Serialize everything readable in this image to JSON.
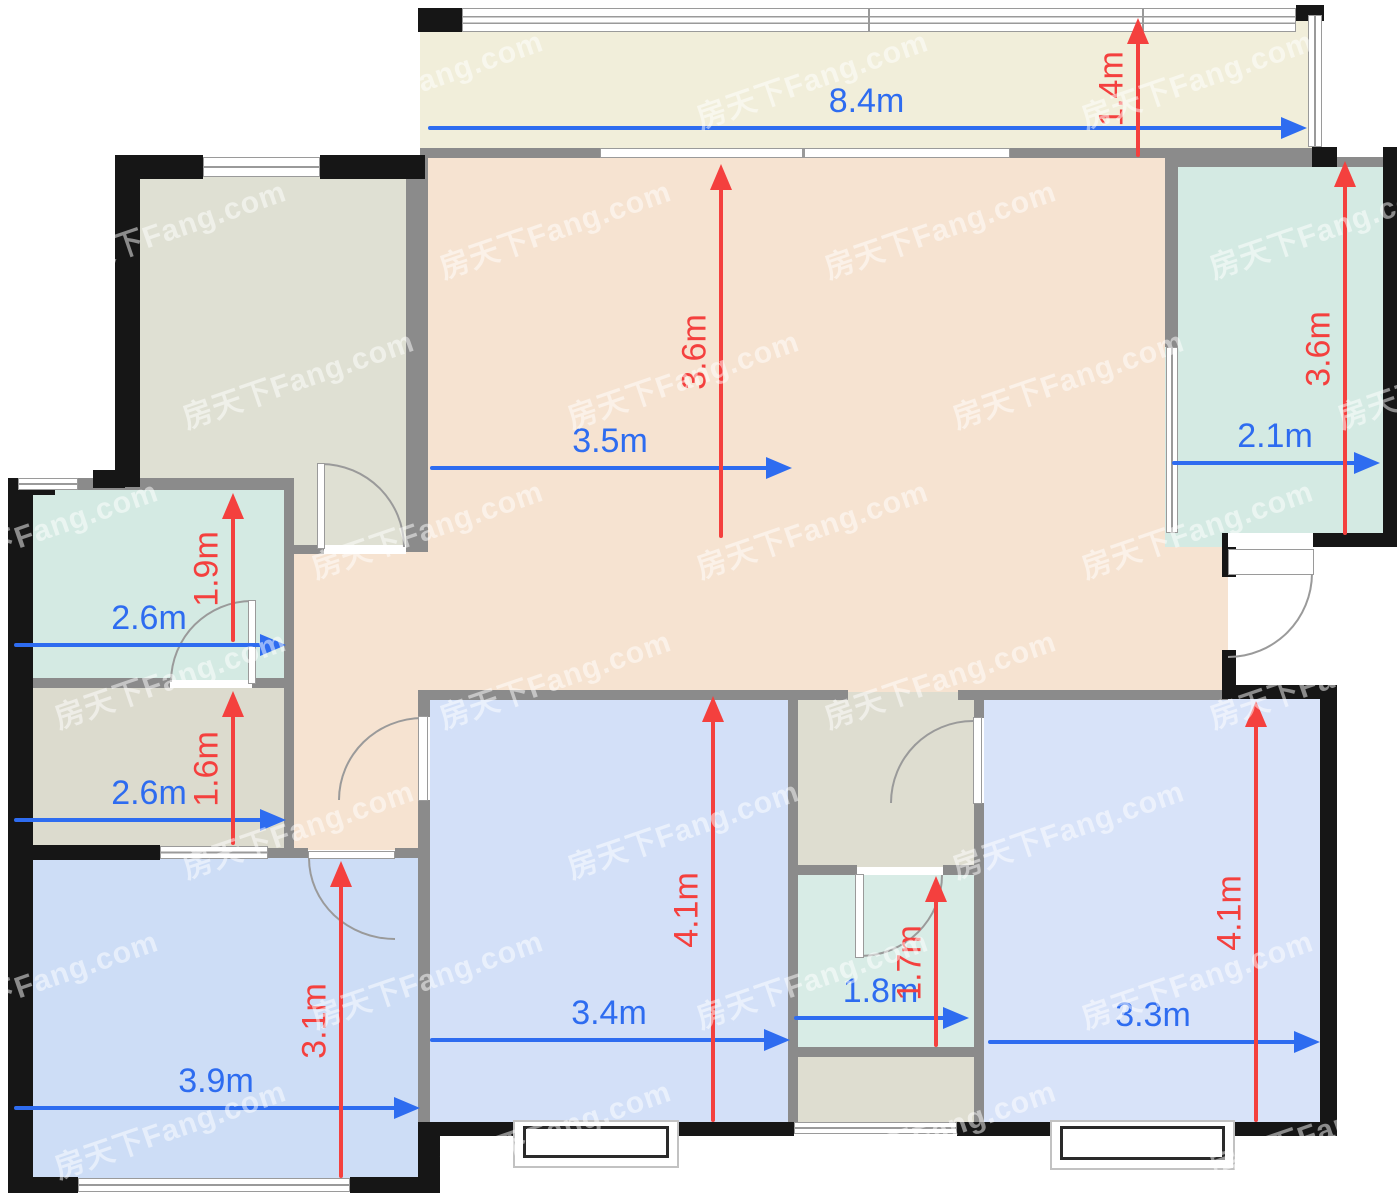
{
  "watermark": {
    "text": "房天下Fang.com"
  },
  "dimensions": {
    "balcony": {
      "width": "8.4m",
      "depth": "1.4m"
    },
    "living_room": {
      "width": "3.5m",
      "depth": "3.6m"
    },
    "room_top_right": {
      "width": "2.1m",
      "depth": "3.6m"
    },
    "bathroom_left": {
      "width": "2.6m",
      "depth": "1.9m"
    },
    "storage_left": {
      "width": "2.6m",
      "depth": "1.6m"
    },
    "bedroom_bottom_left": {
      "width": "3.9m",
      "depth": "3.1m"
    },
    "bedroom_bottom_center": {
      "width": "3.4m",
      "depth": "4.1m"
    },
    "bathroom_middle": {
      "width": "1.8m",
      "depth": "1.7m"
    },
    "bedroom_bottom_right": {
      "width": "3.3m",
      "depth": "4.1m"
    }
  },
  "colors": {
    "dimension_blue": "#2e6cf0",
    "dimension_red": "#f4403e",
    "wall_black": "#161616",
    "wall_gray": "#8b8b8b",
    "balcony_floor": "#f1eeda",
    "living_floor": "#f6e3d1",
    "gray_room_floor": "#dfe0d3",
    "cyan_room_floor": "#d4eae3",
    "storage_floor": "#dcdbce",
    "bedroom_floor_blue": "#d3e0f8"
  }
}
